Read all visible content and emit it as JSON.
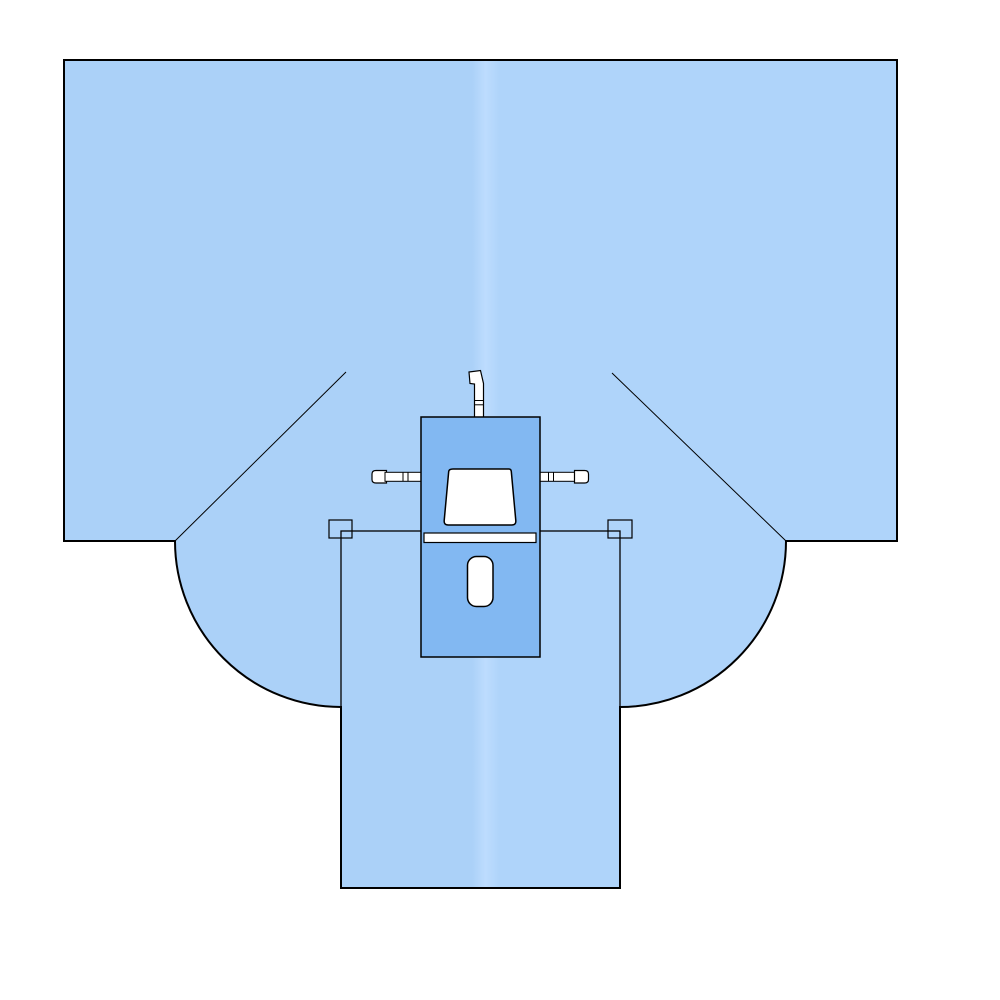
{
  "illustration": {
    "kind": "surgical-drape-technical-diagram",
    "canvas": {
      "width": 1000,
      "height": 1000,
      "background": "#ffffff"
    },
    "colors": {
      "drape_base": "#abd1f8",
      "drape_light": "#afd4fa",
      "fold_highlight": "#bddcfe",
      "panel_fill": "#82b8f2",
      "cutout_fill": "#ffffff",
      "outline": "#000000"
    }
  },
  "svg": {
    "viewBox": "0 0 1000 1000",
    "gradient": {
      "id": "drapeGrad",
      "stops": [
        {
          "offset": "0%",
          "color": "#abd1f8"
        },
        {
          "offset": "49%",
          "color": "#abd1f8"
        },
        {
          "offset": "50.6%",
          "color": "#bddcfe"
        },
        {
          "offset": "52.3%",
          "color": "#afd4fa"
        },
        {
          "offset": "100%",
          "color": "#afd4fa"
        }
      ]
    },
    "elements": [
      {
        "name": "drape-silhouette",
        "tag": "path",
        "attrs": {
          "d": "M64,60 H897 V541 H786 A166,166 0 0 1 620,707 V888 H341 V707 A166,166 0 0 1 175,541 H64 Z",
          "fill": "url(#drapeGrad)",
          "stroke": "#000000",
          "stroke-width": "2"
        }
      },
      {
        "name": "fold-line-left",
        "tag": "line",
        "attrs": {
          "x1": "175",
          "y1": "541",
          "x2": "346",
          "y2": "372",
          "stroke": "#000000",
          "stroke-width": "1"
        }
      },
      {
        "name": "fold-line-right",
        "tag": "line",
        "attrs": {
          "x1": "786",
          "y1": "541",
          "x2": "612",
          "y2": "373",
          "stroke": "#000000",
          "stroke-width": "1"
        }
      },
      {
        "name": "leg-section-outline",
        "tag": "rect",
        "attrs": {
          "x": "341",
          "y": "531",
          "width": "279",
          "height": "357",
          "fill": "none",
          "stroke": "#000000",
          "stroke-width": "1.3"
        }
      },
      {
        "name": "corner-tab-left",
        "tag": "rect",
        "attrs": {
          "x": "329",
          "y": "520",
          "width": "23",
          "height": "18",
          "fill": "none",
          "stroke": "#000000",
          "stroke-width": "1.2"
        }
      },
      {
        "name": "corner-tab-right",
        "tag": "rect",
        "attrs": {
          "x": "608",
          "y": "520",
          "width": "24",
          "height": "18",
          "fill": "none",
          "stroke": "#000000",
          "stroke-width": "1.2"
        }
      },
      {
        "name": "tube-holder-top",
        "tag": "path",
        "attrs": {
          "d": "M469,372 L480.5,370.5 L483.5,383.5 L483.5,417.5 L474.5,417.5 L474.5,384 L470,383.5 Z",
          "fill": "#ffffff",
          "stroke": "#000000",
          "stroke-width": "1.2"
        }
      },
      {
        "name": "tube-holder-top-band-1",
        "tag": "line",
        "attrs": {
          "x1": "474.5",
          "y1": "400.5",
          "x2": "483.5",
          "y2": "400.5",
          "stroke": "#000000",
          "stroke-width": "1"
        }
      },
      {
        "name": "tube-holder-top-band-2",
        "tag": "line",
        "attrs": {
          "x1": "474.5",
          "y1": "404.8",
          "x2": "483.5",
          "y2": "404.8",
          "stroke": "#000000",
          "stroke-width": "1"
        }
      },
      {
        "name": "tube-holder-left-cap",
        "tag": "path",
        "attrs": {
          "d": "M376,470.5 L386.5,470.5 L386.5,483 L376,483 Q372,483 372,479.5 L372,474 Q372,470.5 376,470.5 Z",
          "fill": "#ffffff",
          "stroke": "#000000",
          "stroke-width": "1.2"
        }
      },
      {
        "name": "tube-holder-left-shaft",
        "tag": "rect",
        "attrs": {
          "x": "385",
          "y": "472.3",
          "width": "36",
          "height": "9",
          "fill": "#ffffff",
          "stroke": "#000000",
          "stroke-width": "1"
        }
      },
      {
        "name": "tube-holder-left-band-1",
        "tag": "line",
        "attrs": {
          "x1": "403",
          "y1": "472.3",
          "x2": "403",
          "y2": "481.3",
          "stroke": "#000000",
          "stroke-width": "1"
        }
      },
      {
        "name": "tube-holder-left-band-2",
        "tag": "line",
        "attrs": {
          "x1": "408",
          "y1": "472.3",
          "x2": "408",
          "y2": "481.3",
          "stroke": "#000000",
          "stroke-width": "1"
        }
      },
      {
        "name": "tube-holder-right-shaft",
        "tag": "rect",
        "attrs": {
          "x": "540",
          "y": "472.3",
          "width": "35",
          "height": "9",
          "fill": "#ffffff",
          "stroke": "#000000",
          "stroke-width": "1"
        }
      },
      {
        "name": "tube-holder-right-band-1",
        "tag": "line",
        "attrs": {
          "x1": "548.5",
          "y1": "472.3",
          "x2": "548.5",
          "y2": "481.3",
          "stroke": "#000000",
          "stroke-width": "1"
        }
      },
      {
        "name": "tube-holder-right-band-2",
        "tag": "line",
        "attrs": {
          "x1": "553.5",
          "y1": "472.3",
          "x2": "553.5",
          "y2": "481.3",
          "stroke": "#000000",
          "stroke-width": "1"
        }
      },
      {
        "name": "tube-holder-right-cap",
        "tag": "path",
        "attrs": {
          "d": "M574.5,470.5 L584.5,470.5 Q588.5,470.5 588.5,474 L588.5,479.5 Q588.5,483 584.5,483 L574.5,483 Z",
          "fill": "#ffffff",
          "stroke": "#000000",
          "stroke-width": "1.2"
        }
      },
      {
        "name": "reinforcement-panel",
        "tag": "rect",
        "attrs": {
          "x": "421",
          "y": "417",
          "width": "119",
          "height": "240",
          "fill": "#82b8f2",
          "stroke": "#000000",
          "stroke-width": "1.5"
        }
      },
      {
        "name": "fenestration-trapezoid",
        "tag": "path",
        "attrs": {
          "d": "M453,469 L509,469 Q511,469 511.3,471.5 L515.8,520.5 Q516.2,525 511.8,525 L448.2,525 Q443.8,525 444.2,520.5 L448.7,471.5 Q449,469 453,469 Z",
          "fill": "#ffffff",
          "stroke": "#000000",
          "stroke-width": "1.5"
        }
      },
      {
        "name": "adhesive-strip",
        "tag": "rect",
        "attrs": {
          "x": "424",
          "y": "533",
          "width": "112",
          "height": "9.5",
          "fill": "#ffffff",
          "stroke": "#000000",
          "stroke-width": "1.2"
        }
      },
      {
        "name": "fenestration-slot",
        "tag": "rect",
        "attrs": {
          "x": "467.5",
          "y": "556.5",
          "width": "25.5",
          "height": "50",
          "rx": "9",
          "fill": "#ffffff",
          "stroke": "#000000",
          "stroke-width": "1.5"
        }
      }
    ]
  }
}
